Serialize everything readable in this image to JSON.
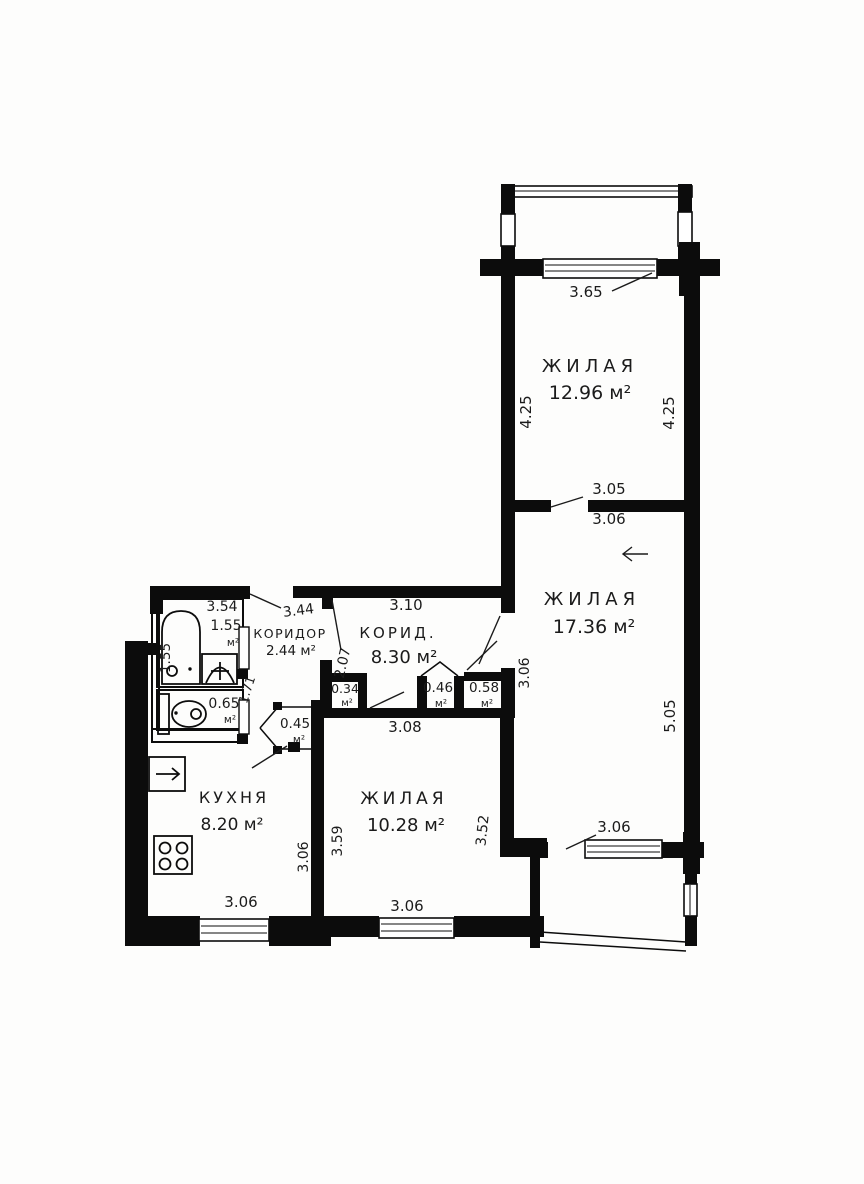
{
  "plan": {
    "r1": {
      "name": "ЖИЛАЯ",
      "area": "12.96 м²",
      "top": "3.65",
      "left": "4.25",
      "right": "4.25"
    },
    "r2": {
      "name": "ЖИЛАЯ",
      "area": "17.36 м²",
      "door": "3.05",
      "top": "3.06",
      "left": "3.06",
      "right": "5.05",
      "balcony": "3.06"
    },
    "r3": {
      "name": "ЖИЛАЯ",
      "area": "10.28 м²",
      "top": "3.08",
      "left": "3.59",
      "right": "3.52",
      "bottom": "3.06"
    },
    "kitchen": {
      "name": "КУХНЯ",
      "area": "8.20 м²",
      "right": "3.06",
      "bottom": "3.06"
    },
    "hall": {
      "name": "КОРИД.",
      "area": "8.30 м²",
      "top": "3.10",
      "left": "2.07"
    },
    "corridor": {
      "name": "КОРИДОР",
      "area": "2.44 м²",
      "top": "3.44"
    },
    "bath": {
      "top": "3.54",
      "area": "1.55",
      "unit": "м²",
      "left": "1.55",
      "jamb": "1.71"
    },
    "wc": {
      "area": "0.65",
      "unit": "м²"
    },
    "c1": {
      "area": "0.34",
      "unit": "м²"
    },
    "c2": {
      "area": "0.45",
      "unit": "м²"
    },
    "c3": {
      "area": "0.46",
      "unit": "м²"
    },
    "c4": {
      "area": "0.58",
      "unit": "м²"
    }
  },
  "colors": {
    "wall": "#0c0c0c",
    "background": "#fdfdfc",
    "text": "#1b1b1b"
  }
}
